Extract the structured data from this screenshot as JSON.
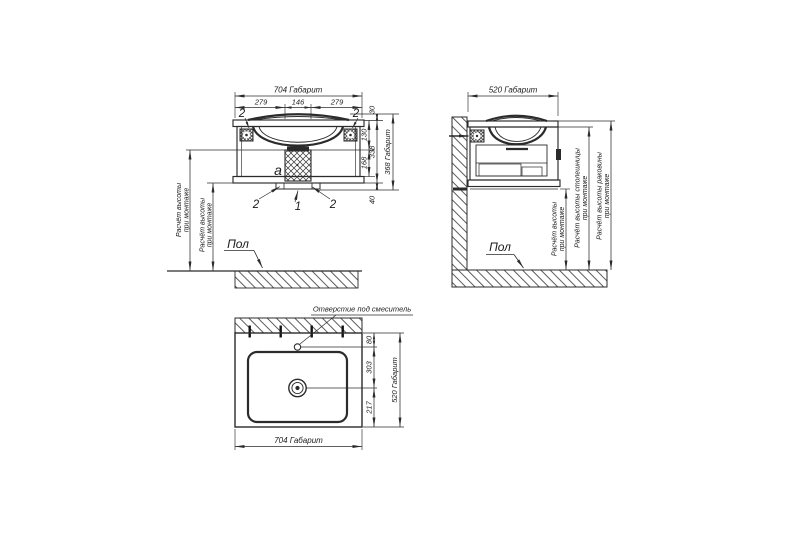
{
  "drawing": {
    "background": "#ffffff",
    "line_color": "#2b2b2b"
  },
  "front_view": {
    "dim_width_total": "704 Габарит",
    "dim_width_left": "279",
    "dim_width_center": "146",
    "dim_width_right": "279",
    "dim_rim": "30",
    "dim_basin_section": "130",
    "dim_body": "338",
    "dim_lower_section": "168",
    "dim_plinth": "40",
    "dim_height_total": "368 Габарит",
    "label_siphon": "a",
    "callout_top_left": "2",
    "callout_top_right": "2",
    "callout_bottom_left": "2",
    "callout_bottom_center": "1",
    "callout_bottom_right": "2",
    "note_mount_1": {
      "line1": "Расчёт высоты",
      "line2": "при монтаже"
    },
    "note_mount_2": {
      "line1": "Расчёт высоты",
      "line2": "при монтаже"
    },
    "label_floor": "Пол"
  },
  "side_view": {
    "dim_depth_total": "520 Габарит",
    "note_mount": {
      "line1": "Расчёт высоты",
      "line2": "при монтаже"
    },
    "note_countertop": {
      "line1": "Расчёт высоты столешницы",
      "line2": "при монтаже"
    },
    "note_basin": {
      "line1": "Расчёт высоты раковины",
      "line2": "при монтаже"
    },
    "label_floor": "Пол"
  },
  "top_view": {
    "label_faucet_hole": "Отверстие под смеситель",
    "dim_back_to_faucet": "80",
    "dim_back_to_drain": "303",
    "dim_drain_to_front": "217",
    "dim_depth_total": "520 Габарит",
    "dim_width_total": "704 Габарит"
  }
}
